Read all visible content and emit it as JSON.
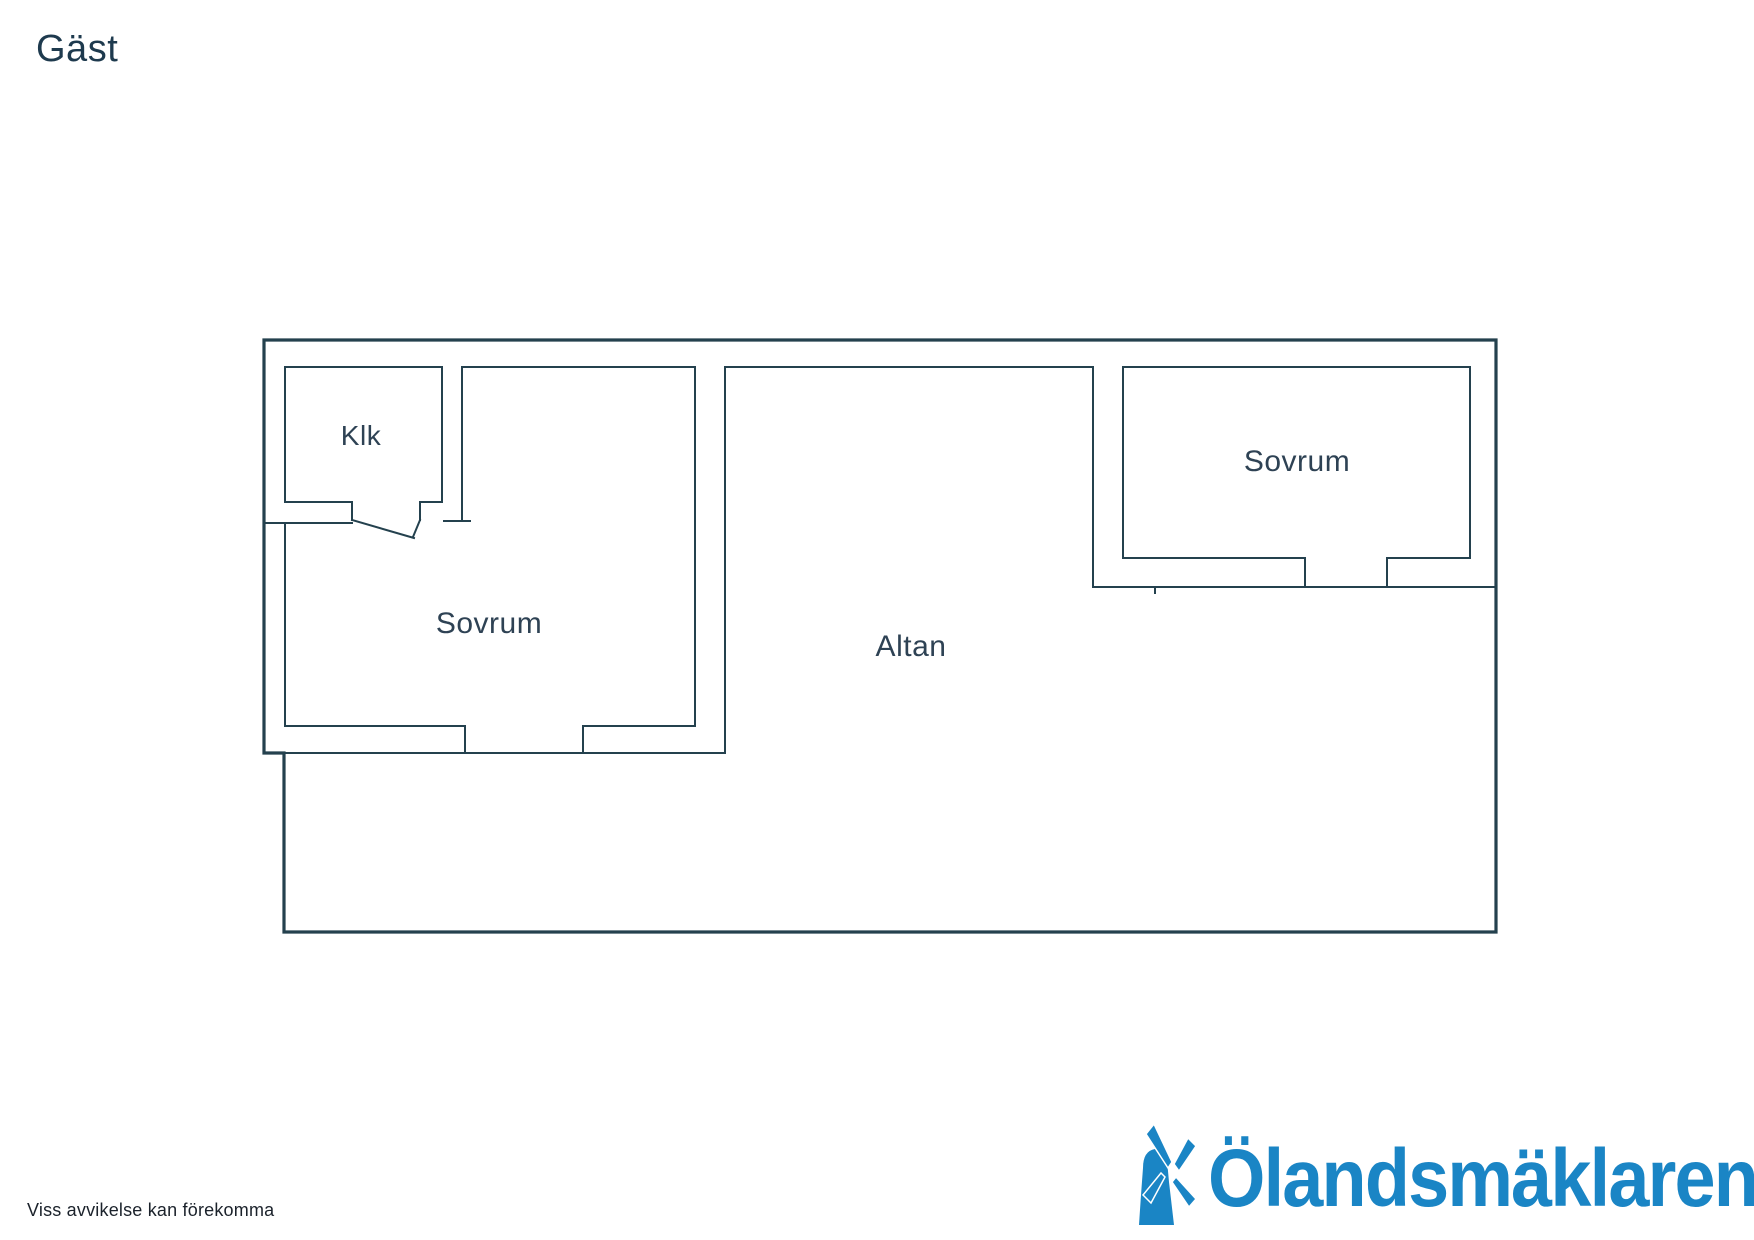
{
  "page": {
    "title": "Gäst",
    "disclaimer": "Viss avvikelse kan förekomma"
  },
  "floorplan": {
    "rooms": [
      {
        "id": "klk",
        "label": "Klk"
      },
      {
        "id": "sovrum-left",
        "label": "Sovrum"
      },
      {
        "id": "altan",
        "label": "Altan"
      },
      {
        "id": "sovrum-right",
        "label": "Sovrum"
      }
    ]
  },
  "logo": {
    "text": "Ölandsmäklaren",
    "icon": "windmill-icon",
    "color": "#1a85c5"
  },
  "colors": {
    "wall": "#24414e",
    "label": "#2e4254",
    "title": "#1e3a4e",
    "disclaimer": "#1b222b",
    "background": "#ffffff"
  }
}
